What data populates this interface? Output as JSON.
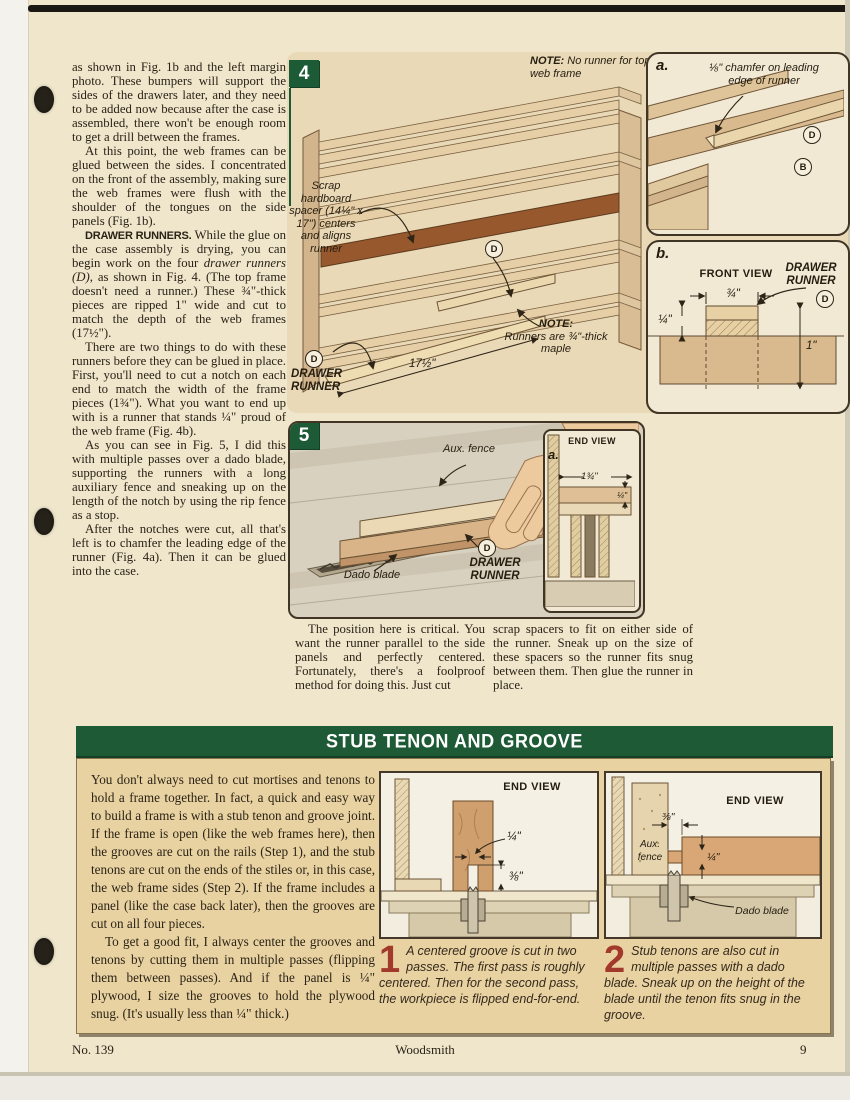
{
  "page": {
    "footer_issue": "No. 139",
    "footer_title": "Woodsmith",
    "footer_page": "9"
  },
  "article": {
    "col1": {
      "p1": "as shown in Fig. 1b and the left margin photo. These bumpers will support the sides of the drawers later, and they need to be added now because after the case is assembled, there won't be enough room to get a drill between the frames.",
      "p2": "At this point, the web frames can be glued between the sides. I concentrated on the front of the assembly, making sure the web frames were flush with the shoulder of the tongues on the side panels (Fig. 1b).",
      "p3_lead": "DRAWER RUNNERS.",
      "p3_a": " While the glue on the case assembly is drying, you can begin work on the four ",
      "p3_em": "drawer runners (D)",
      "p3_b": ", as shown in Fig. 4. (The top frame doesn't need a runner.) These ¾\"-thick pieces are ripped 1\" wide and cut to match the depth of the web frames (17½\").",
      "p4": "There are two things to do with these runners before they can be glued in place. First, you'll need to cut a notch on each end to match the width of the frame pieces (1¾\"). What you want to end up with is a runner that stands ¼\" proud of the web frame (Fig. 4b).",
      "p5": "As you can see in Fig. 5, I did this with multiple passes over a dado blade, supporting the runners with a long auxiliary fence and sneaking up on the length of the notch by using the rip fence as a stop.",
      "p6": "After the notches were cut, all that's left is to chamfer the leading edge of the runner (Fig. 4a). Then it can be glued into the case."
    },
    "col2_p": "The position here is critical. You want the runner parallel to the side panels and perfectly centered. Fortunately, there's a foolproof method for doing this. Just cut",
    "col3_p": "scrap spacers to fit on either side of the runner. Sneak up on the size of these spacers so the runner fits snug between them. Then glue the runner in place."
  },
  "figure4": {
    "number": "4",
    "note_top_label": "NOTE:",
    "note_top_text": " No runner for top web frame",
    "spacer_label": "Scrap hardboard spacer (14¼\" x 17\") centers and aligns runner",
    "note_runner_label": "NOTE:",
    "note_runner_text": "Runners are ¾\"-thick maple",
    "dim_length": "17½\"",
    "runner_label": "DRAWER RUNNER",
    "part_d": "D",
    "part_b": "B",
    "inset_a": {
      "tag": "a.",
      "note": "⅛\" chamfer on leading edge of runner"
    },
    "inset_b": {
      "tag": "b.",
      "view": "FRONT VIEW",
      "runner_label": "DRAWER RUNNER",
      "dim_width": "¾\"",
      "dim_proud": "¼\"",
      "dim_height": "1\""
    }
  },
  "figure5": {
    "number": "5",
    "aux_fence": "Aux. fence",
    "dado_blade": "Dado blade",
    "runner_label": "DRAWER RUNNER",
    "part_d": "D",
    "inset_a": {
      "tag": "a.",
      "view": "END VIEW",
      "dim_width": "1¾\"",
      "dim_proud": "¼\""
    }
  },
  "sidebar": {
    "title": "STUB TENON AND GROOVE",
    "p1": "You don't always need to cut mortises and tenons to hold a frame together. In fact, a quick and easy way to build a frame is with a stub tenon and groove joint. If the frame is open (like the web frames here), then the grooves are cut on the rails (Step 1), and the stub tenons are cut on the ends of the stiles or, in this case, the web frame sides (Step 2). If the frame includes a panel (like the case back later), then the grooves are cut on all four pieces.",
    "p2": "To get a good fit, I always center the grooves and tenons by cutting them in multiple passes (flipping them between passes). And if the panel is ¼\" plywood, I size the grooves to hold the plywood snug. (It's usually less than ¼\" thick.)",
    "step1": {
      "num": "1",
      "view": "END VIEW",
      "dim_groove": "¼\"",
      "dim_depth": "⅜\"",
      "caption": "A centered groove is cut in two passes. The first pass is roughly centered. Then for the second pass, the workpiece is flipped end-for-end."
    },
    "step2": {
      "num": "2",
      "view": "END VIEW",
      "aux_fence": "Aux. fence",
      "dado_blade": "Dado blade",
      "dim_tenon": "⅜\"",
      "dim_thick": "¼\"",
      "caption": "Stub tenons are also cut in multiple passes with a dado blade. Sneak up on the height of the blade until the tenon fits snug in the groove."
    }
  }
}
